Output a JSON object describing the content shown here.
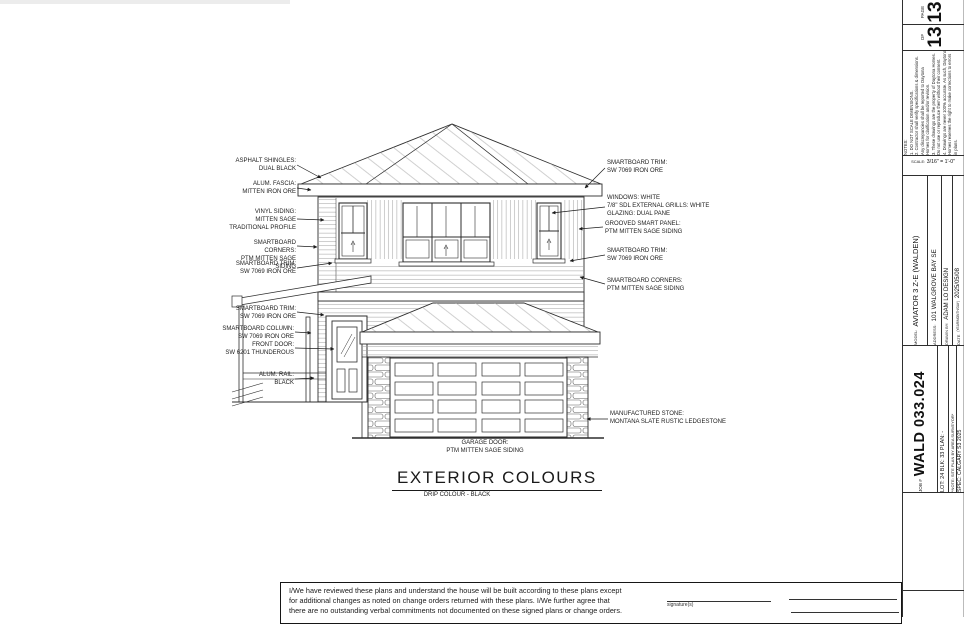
{
  "colors": {
    "ink": "#2b2b2b",
    "paper": "#ffffff"
  },
  "sheet": {
    "page_label": "PAGE",
    "page_value": "13",
    "of_label": "OF",
    "of_value": "13",
    "notes_text": "NOTES:\n1. DO NOT SCALE DIMENSIONS.\n2. Contractor shall verify specifications & dimensions.\nAny discrepancies shall be reported to Daytona\nHomes for clarification and/or revision.\n3. These drawings are the property of Daytona Homes.\nDo not use or reproduce them without their consent.\n4. Drawings are never 100% accurate. As such, Daytona\nHomes reserves the right to make corrections to errors\nin plans.",
    "scale_label": "SCALE:",
    "scale_value": "3/16\" = 1'-0\"",
    "model_label": "MODEL:",
    "model_value": "AVIATOR 3 Z-E (WALDEN)",
    "address_label": "ADDRESS:",
    "address_value": "101 WALGROVE BAY SE",
    "drawn_label": "DRAWN BY:",
    "drawn_value": "ADAM LO DESIGN",
    "date_label": "DATE",
    "date_sub": "(YEAR/MONTH/DAY)",
    "date_value": "2025/05/08",
    "job_label": "JOB #",
    "job_value": "WALD 033.024",
    "lot_line": "LOT: 24   BLK: 33   PLAN: -",
    "site_note": "*NOTE: SITE PLAN BY AREA SURVEYOR*",
    "spec_line": "SPEC: CALGARY S3 2025"
  },
  "drawing": {
    "title": "EXTERIOR COLOURS",
    "subtitle": "DRIP COLOUR - BLACK",
    "callouts_left": [
      {
        "text": "ASPHALT SHINGLES:\nDUAL BLACK"
      },
      {
        "text": "ALUM. FASCIA:\nMITTEN IRON ORE"
      },
      {
        "text": "VINYL SIDING:\nMITTEN SAGE\nTRADITIONAL PROFILE"
      },
      {
        "text": "SMARTBOARD CORNERS:\nPTM MITTEN SAGE SIDING"
      },
      {
        "text": "SMARTBOARD TRIM:\nSW 7069 IRON ORE"
      },
      {
        "text": "SMARTBOARD TRIM:\nSW 7069 IRON ORE"
      },
      {
        "text": "SMARTBOARD COLUMN:\nSW 7069 IRON ORE"
      },
      {
        "text": "FRONT DOOR:\nSW 6201 THUNDEROUS"
      },
      {
        "text": "ALUM. RAIL:\nBLACK"
      }
    ],
    "callouts_right": [
      {
        "text": "SMARTBOARD TRIM:\nSW 7069 IRON ORE"
      },
      {
        "text": "WINDOWS: WHITE\n7/8\" SDL EXTERNAL GRILLS: WHITE\nGLAZING: DUAL PANE"
      },
      {
        "text": "GROOVED SMART PANEL:\nPTM MITTEN SAGE SIDING"
      },
      {
        "text": "SMARTBOARD TRIM:\nSW 7069 IRON ORE"
      },
      {
        "text": "SMARTBOARD CORNERS:\nPTM MITTEN SAGE SIDING"
      },
      {
        "text": "MANUFACTURED STONE:\nMONTANA SLATE RUSTIC LEDGESTONE"
      }
    ],
    "callout_garage": "GARAGE DOOR:\nPTM MITTEN SAGE SIDING"
  },
  "footer": {
    "agreement": "I/We have reviewed these plans and understand the house will be built according to these plans except\nfor additional changes as noted on change orders returned with these plans. I/We further agree that\nthere are no outstanding verbal commitments not documented on these signed plans or change orders.",
    "signature_label": "signature(s)"
  }
}
